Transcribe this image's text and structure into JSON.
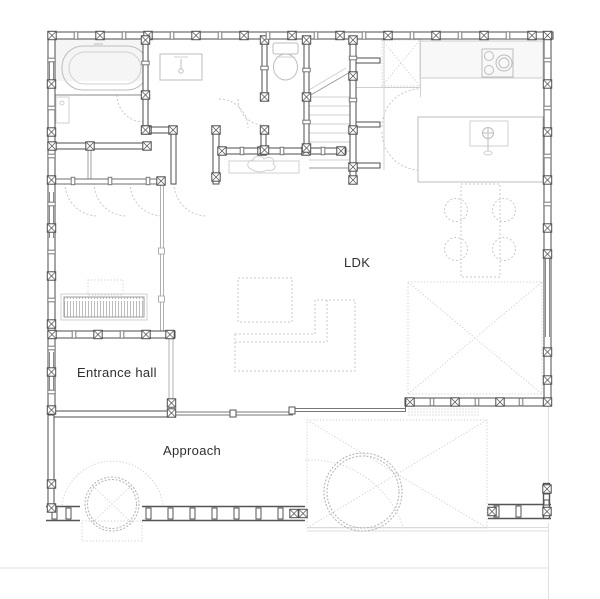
{
  "plan": {
    "labels": {
      "ldk": "LDK",
      "entrance_hall": "Entrance hall",
      "approach": "Approach"
    },
    "colors": {
      "wall": "#4d4d4d",
      "fixture_outline": "#bdbdbd",
      "dashed_furniture": "#c9c9c9",
      "floor_tint": "#f5f5f5",
      "label_text": "#2f2f2f"
    },
    "fixtures": [
      "bathtub",
      "washing-machine",
      "vanity-basin",
      "toilet",
      "staircase",
      "washbasin-counter",
      "kitchen-counter",
      "cooktop",
      "kitchen-island",
      "island-sink",
      "dining-table",
      "dining-chairs",
      "low-table",
      "sofa",
      "tv-board",
      "wood-deck",
      "garden-trees",
      "planter",
      "wood-fence"
    ]
  }
}
